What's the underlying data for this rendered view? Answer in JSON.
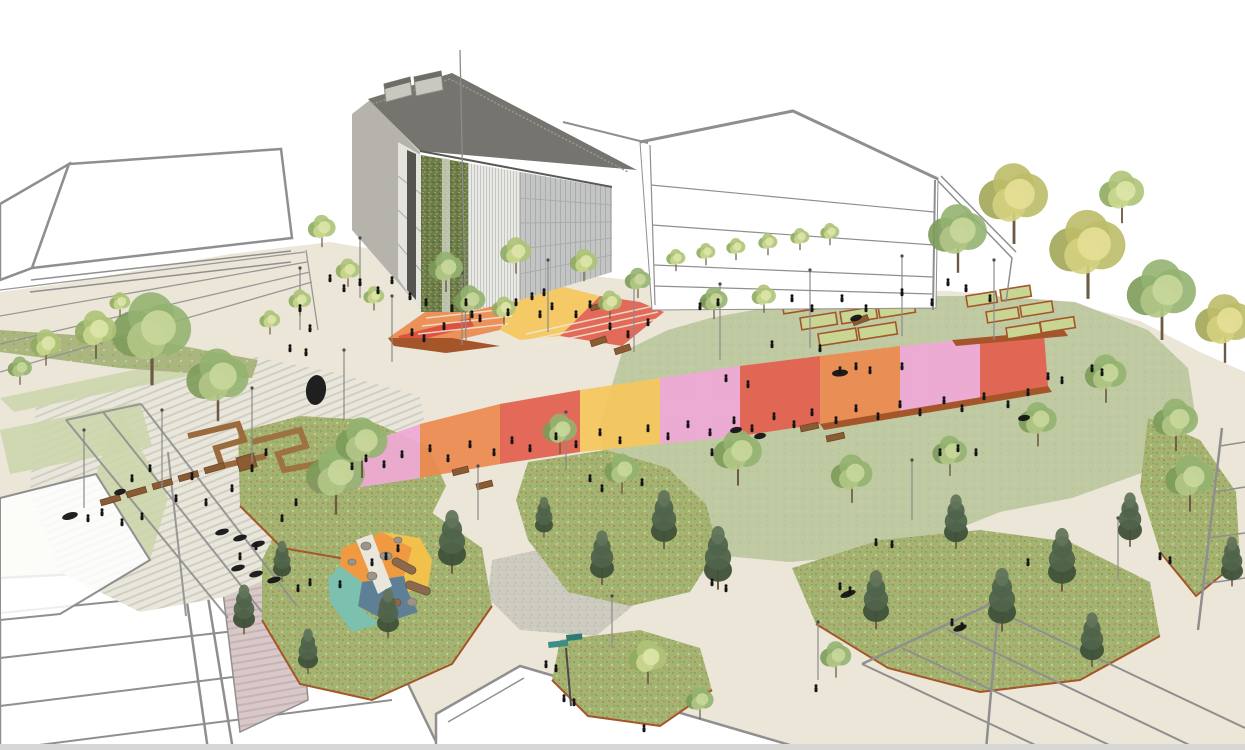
{
  "colors": {
    "background": "#ffffff",
    "ground": "#ebe6d8",
    "outline": "#8f8f8f",
    "paving_light": "#e9e6dc",
    "paving_stripe": "#d2cec1",
    "paving_pink": "#d8c8c8",
    "paving_pink_stripe": "#c6b3b3",
    "lawn": "#bfcaa3",
    "lawn_speckle": "#adbc8d",
    "meadow": "#a3b472",
    "meadow_dark": "#879c55",
    "meadow_light": "#c3d18d",
    "flower_orange": "#d06a34",
    "flower_red": "#bf4b3c",
    "flower_pink": "#d795b5",
    "gravel": "#cdcabf",
    "corten": "#a4562a",
    "wood": "#8a5c33",
    "green_strip": "#ccd6ac",
    "roof": "#76746f",
    "roof_light": "#9a9890",
    "wall_light": "#b5b3ac",
    "wall_white": "#e4e3de",
    "wall_dark": "#55544f",
    "green_wall": "#6d7b48",
    "louver": "#e9e9e5",
    "louver_line": "#c6c6c0",
    "glass": "#c2c5c3",
    "glass_line": "#a9acaa",
    "plaza_orange": "#ec8a4f",
    "plaza_red": "#dd4f3e",
    "plaza_salmon": "#e2604d",
    "plaza_yellow": "#f5c75c",
    "plaza_pink": "#eea9d5",
    "plaza_magenta": "#e77fc1",
    "play_orange": "#ef9a40",
    "play_yellow": "#f2c14b",
    "play_teal": "#7cc0af",
    "play_blue": "#5e7f95",
    "sign_teal": "#3c8f86",
    "people": "#151515",
    "pole": "#8b8b8b",
    "step_line": "#efe9d9",
    "bottom_strip": "#d7d7d5",
    "bed_fill": "#c9d693",
    "log": "#8a6a4c",
    "log_edge": "#6f5438",
    "boulder": "#9b948a",
    "trunk": "#6b5a44"
  },
  "tree_palettes": {
    "deciduous": [
      "#7c9b59",
      "#94b370",
      "#b2c786",
      "#c9d79b"
    ],
    "light": [
      "#90ab60",
      "#aec378",
      "#cbd88f",
      "#dde5a8"
    ],
    "yellow": [
      "#a3a656",
      "#bcbd68",
      "#d4d17e",
      "#e4df96"
    ],
    "pine": [
      "#3f5138",
      "#50644b",
      "#62755a",
      "#74876c"
    ]
  },
  "scene": {
    "trees": [
      [
        152,
        330,
        46,
        "deciduous"
      ],
      [
        218,
        378,
        36,
        "deciduous"
      ],
      [
        96,
        330,
        24,
        "light"
      ],
      [
        46,
        344,
        18,
        "light"
      ],
      [
        20,
        368,
        14,
        "deciduous"
      ],
      [
        120,
        302,
        12,
        "light"
      ],
      [
        322,
        228,
        16,
        "light"
      ],
      [
        348,
        270,
        14,
        "light"
      ],
      [
        300,
        300,
        13,
        "light"
      ],
      [
        270,
        320,
        12,
        "light"
      ],
      [
        374,
        296,
        12,
        "light"
      ],
      [
        446,
        268,
        20,
        "deciduous"
      ],
      [
        516,
        252,
        18,
        "light"
      ],
      [
        584,
        262,
        16,
        "light"
      ],
      [
        638,
        280,
        15,
        "deciduous"
      ],
      [
        714,
        300,
        16,
        "deciduous"
      ],
      [
        764,
        296,
        14,
        "light"
      ],
      [
        676,
        258,
        11,
        "light"
      ],
      [
        706,
        252,
        11,
        "light"
      ],
      [
        736,
        247,
        11,
        "light"
      ],
      [
        768,
        242,
        11,
        "light"
      ],
      [
        800,
        237,
        11,
        "light"
      ],
      [
        830,
        232,
        11,
        "light"
      ],
      [
        958,
        232,
        34,
        "deciduous"
      ],
      [
        1014,
        196,
        40,
        "yellow"
      ],
      [
        1088,
        246,
        44,
        "yellow"
      ],
      [
        1162,
        292,
        40,
        "deciduous"
      ],
      [
        1225,
        322,
        34,
        "yellow"
      ],
      [
        1122,
        192,
        26,
        "light"
      ],
      [
        738,
        452,
        28,
        "deciduous"
      ],
      [
        852,
        474,
        24,
        "deciduous"
      ],
      [
        950,
        452,
        20,
        "deciduous"
      ],
      [
        1038,
        420,
        22,
        "deciduous"
      ],
      [
        1106,
        374,
        24,
        "deciduous"
      ],
      [
        1176,
        420,
        26,
        "deciduous"
      ],
      [
        956,
        520,
        24,
        "pine"
      ],
      [
        1062,
        558,
        28,
        "pine"
      ],
      [
        1130,
        518,
        24,
        "pine"
      ],
      [
        876,
        598,
        26,
        "pine"
      ],
      [
        1002,
        598,
        28,
        "pine"
      ],
      [
        1092,
        638,
        24,
        "pine"
      ],
      [
        560,
        430,
        20,
        "deciduous"
      ],
      [
        622,
        470,
        20,
        "deciduous"
      ],
      [
        664,
        518,
        26,
        "pine"
      ],
      [
        718,
        556,
        28,
        "pine"
      ],
      [
        602,
        556,
        24,
        "pine"
      ],
      [
        544,
        516,
        18,
        "pine"
      ],
      [
        452,
        540,
        28,
        "pine"
      ],
      [
        388,
        612,
        22,
        "pine"
      ],
      [
        336,
        474,
        34,
        "deciduous"
      ],
      [
        282,
        560,
        18,
        "pine"
      ],
      [
        244,
        608,
        22,
        "pine"
      ],
      [
        308,
        650,
        20,
        "pine"
      ],
      [
        648,
        658,
        22,
        "light"
      ],
      [
        700,
        700,
        16,
        "deciduous"
      ],
      [
        836,
        656,
        18,
        "deciduous"
      ],
      [
        1190,
        478,
        28,
        "deciduous"
      ],
      [
        1232,
        560,
        22,
        "pine"
      ],
      [
        470,
        300,
        18,
        "deciduous"
      ],
      [
        504,
        308,
        14,
        "light"
      ],
      [
        610,
        302,
        14,
        "light"
      ],
      [
        362,
        442,
        30,
        "deciduous"
      ]
    ],
    "people": [
      [
        472,
        318
      ],
      [
        480,
        322
      ],
      [
        508,
        316
      ],
      [
        516,
        306
      ],
      [
        540,
        318
      ],
      [
        552,
        310
      ],
      [
        576,
        318
      ],
      [
        590,
        308
      ],
      [
        412,
        336
      ],
      [
        424,
        342
      ],
      [
        444,
        330
      ],
      [
        610,
        330
      ],
      [
        628,
        338
      ],
      [
        648,
        326
      ],
      [
        532,
        300
      ],
      [
        544,
        296
      ],
      [
        352,
        470
      ],
      [
        366,
        462
      ],
      [
        384,
        468
      ],
      [
        402,
        458
      ],
      [
        430,
        452
      ],
      [
        448,
        462
      ],
      [
        470,
        448
      ],
      [
        494,
        456
      ],
      [
        512,
        444
      ],
      [
        530,
        452
      ],
      [
        556,
        440
      ],
      [
        576,
        448
      ],
      [
        600,
        436
      ],
      [
        620,
        444
      ],
      [
        648,
        432
      ],
      [
        668,
        440
      ],
      [
        688,
        428
      ],
      [
        710,
        436
      ],
      [
        734,
        424
      ],
      [
        752,
        432
      ],
      [
        774,
        420
      ],
      [
        794,
        428
      ],
      [
        812,
        416
      ],
      [
        836,
        424
      ],
      [
        856,
        412
      ],
      [
        878,
        420
      ],
      [
        900,
        408
      ],
      [
        920,
        416
      ],
      [
        944,
        404
      ],
      [
        962,
        412
      ],
      [
        984,
        400
      ],
      [
        1008,
        408
      ],
      [
        1028,
        396
      ],
      [
        726,
        382
      ],
      [
        748,
        388
      ],
      [
        772,
        348
      ],
      [
        820,
        352
      ],
      [
        840,
        374
      ],
      [
        856,
        370
      ],
      [
        870,
        374
      ],
      [
        902,
        370
      ],
      [
        940,
        456
      ],
      [
        958,
        452
      ],
      [
        976,
        456
      ],
      [
        1048,
        380
      ],
      [
        1062,
        384
      ],
      [
        712,
        456
      ],
      [
        88,
        522
      ],
      [
        102,
        516
      ],
      [
        122,
        526
      ],
      [
        142,
        520
      ],
      [
        176,
        502
      ],
      [
        192,
        480
      ],
      [
        206,
        506
      ],
      [
        232,
        492
      ],
      [
        252,
        472
      ],
      [
        266,
        456
      ],
      [
        282,
        522
      ],
      [
        296,
        506
      ],
      [
        150,
        472
      ],
      [
        132,
        482
      ],
      [
        240,
        560
      ],
      [
        256,
        550
      ],
      [
        330,
        282
      ],
      [
        344,
        292
      ],
      [
        360,
        286
      ],
      [
        378,
        294
      ],
      [
        392,
        284
      ],
      [
        300,
        312
      ],
      [
        310,
        332
      ],
      [
        290,
        352
      ],
      [
        306,
        356
      ],
      [
        410,
        300
      ],
      [
        426,
        306
      ],
      [
        792,
        302
      ],
      [
        812,
        312
      ],
      [
        842,
        302
      ],
      [
        866,
        312
      ],
      [
        902,
        296
      ],
      [
        932,
        306
      ],
      [
        966,
        292
      ],
      [
        990,
        302
      ],
      [
        1092,
        372
      ],
      [
        1102,
        376
      ],
      [
        948,
        286
      ],
      [
        546,
        668
      ],
      [
        556,
        672
      ],
      [
        564,
        702
      ],
      [
        574,
        706
      ],
      [
        590,
        482
      ],
      [
        602,
        492
      ],
      [
        642,
        486
      ],
      [
        876,
        546
      ],
      [
        892,
        548
      ],
      [
        1028,
        566
      ],
      [
        840,
        590
      ],
      [
        850,
        594
      ],
      [
        952,
        626
      ],
      [
        962,
        630
      ],
      [
        816,
        692
      ],
      [
        644,
        732
      ],
      [
        712,
        586
      ],
      [
        726,
        592
      ],
      [
        1160,
        560
      ],
      [
        1170,
        564
      ],
      [
        452,
        312
      ],
      [
        466,
        306
      ],
      [
        700,
        310
      ],
      [
        718,
        306
      ],
      [
        372,
        566
      ],
      [
        386,
        560
      ],
      [
        398,
        552
      ],
      [
        340,
        588
      ],
      [
        310,
        586
      ],
      [
        298,
        592
      ]
    ],
    "blobs": [
      [
        70,
        516,
        16,
        7,
        -15
      ],
      [
        222,
        532,
        14,
        6,
        -15
      ],
      [
        240,
        538,
        14,
        6,
        -15
      ],
      [
        258,
        544,
        14,
        6,
        -15
      ],
      [
        238,
        568,
        14,
        6,
        -15
      ],
      [
        256,
        574,
        14,
        6,
        -15
      ],
      [
        274,
        580,
        14,
        6,
        -15
      ],
      [
        316,
        390,
        20,
        30,
        6
      ],
      [
        840,
        373,
        16,
        7,
        -5
      ],
      [
        736,
        430,
        12,
        6,
        -10
      ],
      [
        760,
        436,
        12,
        6,
        -10
      ],
      [
        848,
        594,
        16,
        6,
        -20
      ],
      [
        960,
        628,
        14,
        6,
        -20
      ],
      [
        120,
        492,
        12,
        6,
        -15
      ],
      [
        856,
        318,
        12,
        6,
        -18
      ],
      [
        1024,
        418,
        12,
        6,
        -8
      ]
    ],
    "benches": [
      [
        100,
        500,
        20,
        6,
        -16
      ],
      [
        126,
        492,
        20,
        6,
        -16
      ],
      [
        152,
        484,
        20,
        6,
        -16
      ],
      [
        178,
        476,
        20,
        6,
        -16
      ],
      [
        204,
        468,
        20,
        6,
        -16
      ],
      [
        236,
        458,
        18,
        14,
        -16
      ],
      [
        590,
        341,
        16,
        6,
        -18
      ],
      [
        614,
        349,
        16,
        6,
        -18
      ],
      [
        800,
        426,
        18,
        6,
        -12
      ],
      [
        826,
        436,
        18,
        6,
        -12
      ],
      [
        852,
        320,
        16,
        6,
        -20
      ],
      [
        452,
        470,
        16,
        6,
        -14
      ],
      [
        476,
        484,
        16,
        6,
        -14
      ],
      [
        700,
        300,
        14,
        6,
        -15
      ],
      [
        590,
        306,
        14,
        5,
        -15
      ]
    ],
    "garden_beds": [
      [
        782,
        302,
        34,
        12,
        -9
      ],
      [
        820,
        296,
        34,
        12,
        -9
      ],
      [
        858,
        290,
        34,
        12,
        -9
      ],
      [
        800,
        318,
        36,
        12,
        -9
      ],
      [
        840,
        312,
        36,
        12,
        -9
      ],
      [
        878,
        306,
        36,
        12,
        -9
      ],
      [
        818,
        334,
        38,
        12,
        -9
      ],
      [
        858,
        328,
        38,
        12,
        -9
      ],
      [
        966,
        296,
        30,
        11,
        -9
      ],
      [
        1000,
        290,
        30,
        11,
        -9
      ],
      [
        986,
        312,
        32,
        11,
        -9
      ],
      [
        1020,
        306,
        32,
        11,
        -9
      ],
      [
        1006,
        328,
        34,
        11,
        -9
      ],
      [
        1040,
        322,
        34,
        11,
        -9
      ]
    ],
    "poles": [
      [
        462,
        345,
        72
      ],
      [
        548,
        332,
        72
      ],
      [
        634,
        352,
        74
      ],
      [
        720,
        360,
        76
      ],
      [
        810,
        348,
        78
      ],
      [
        902,
        336,
        80
      ],
      [
        994,
        340,
        80
      ],
      [
        392,
        362,
        66
      ],
      [
        344,
        420,
        70
      ],
      [
        252,
        462,
        74
      ],
      [
        162,
        488,
        78
      ],
      [
        84,
        508,
        78
      ],
      [
        566,
        470,
        58
      ],
      [
        478,
        520,
        54
      ],
      [
        912,
        520,
        60
      ],
      [
        1118,
        580,
        62
      ],
      [
        818,
        680,
        58
      ],
      [
        612,
        648,
        52
      ],
      [
        360,
        298,
        60
      ],
      [
        300,
        330,
        62
      ]
    ],
    "plaza_patches": [
      {
        "p": "388,338 448,296 520,288 500,330 448,342",
        "c": "plaza_orange"
      },
      {
        "p": "398,336 470,318 474,326 404,344",
        "c": "plaza_red"
      },
      {
        "p": "500,330 520,288 560,286 600,296 560,336 520,340",
        "c": "plaza_yellow"
      },
      {
        "p": "560,336 600,296 640,302 664,312 622,346",
        "c": "plaza_salmon"
      },
      {
        "p": "318,470 352,448 330,492 308,488",
        "c": "plaza_magenta"
      },
      {
        "p": "352,448 420,424 420,478 330,492",
        "c": "plaza_pink"
      },
      {
        "p": "420,424 500,404 500,464 420,478",
        "c": "plaza_orange"
      },
      {
        "p": "500,404 580,390 580,452 500,464",
        "c": "plaza_salmon"
      },
      {
        "p": "580,390 660,378 660,444 580,452",
        "c": "plaza_yellow"
      },
      {
        "p": "660,378 740,366 740,436 660,444",
        "c": "plaza_pink"
      },
      {
        "p": "740,366 820,356 820,424 740,436",
        "c": "plaza_salmon"
      },
      {
        "p": "820,356 900,346 900,412 820,424",
        "c": "plaza_orange"
      },
      {
        "p": "900,346 980,338 980,398 900,412",
        "c": "plaza_pink"
      },
      {
        "p": "980,338 1044,334 1048,386 980,398",
        "c": "plaza_salmon"
      }
    ],
    "plaza_walls": [
      "388,338 452,338 500,346 446,353 394,346",
      "820,424 1048,386 1052,392 824,430",
      "952,340 1064,330 1068,336 956,346"
    ],
    "play_patches": [
      {
        "p": "342,548 382,532 412,548 404,576 362,582 340,566",
        "c": "play_orange"
      },
      {
        "p": "382,532 420,538 432,560 428,588 406,592 404,576 412,548",
        "c": "play_yellow"
      },
      {
        "p": "362,582 404,576 408,592 418,612 388,622 358,606",
        "c": "play_blue"
      },
      {
        "p": "340,566 362,582 358,606 380,624 352,632 330,602 328,578",
        "c": "play_teal"
      },
      {
        "p": "356,540 372,534 392,586 378,594",
        "c": "paving_light"
      }
    ],
    "logs": [
      [
        404,
        566,
        26,
        8,
        28
      ],
      [
        418,
        588,
        26,
        8,
        20
      ],
      [
        390,
        604,
        22,
        7,
        -12
      ]
    ],
    "boulders": [
      [
        366,
        546,
        5,
        4
      ],
      [
        386,
        556,
        6,
        4
      ],
      [
        372,
        576,
        5,
        4
      ],
      [
        398,
        540,
        4,
        3
      ],
      [
        352,
        562,
        4,
        3
      ],
      [
        412,
        602,
        5,
        4
      ]
    ]
  }
}
